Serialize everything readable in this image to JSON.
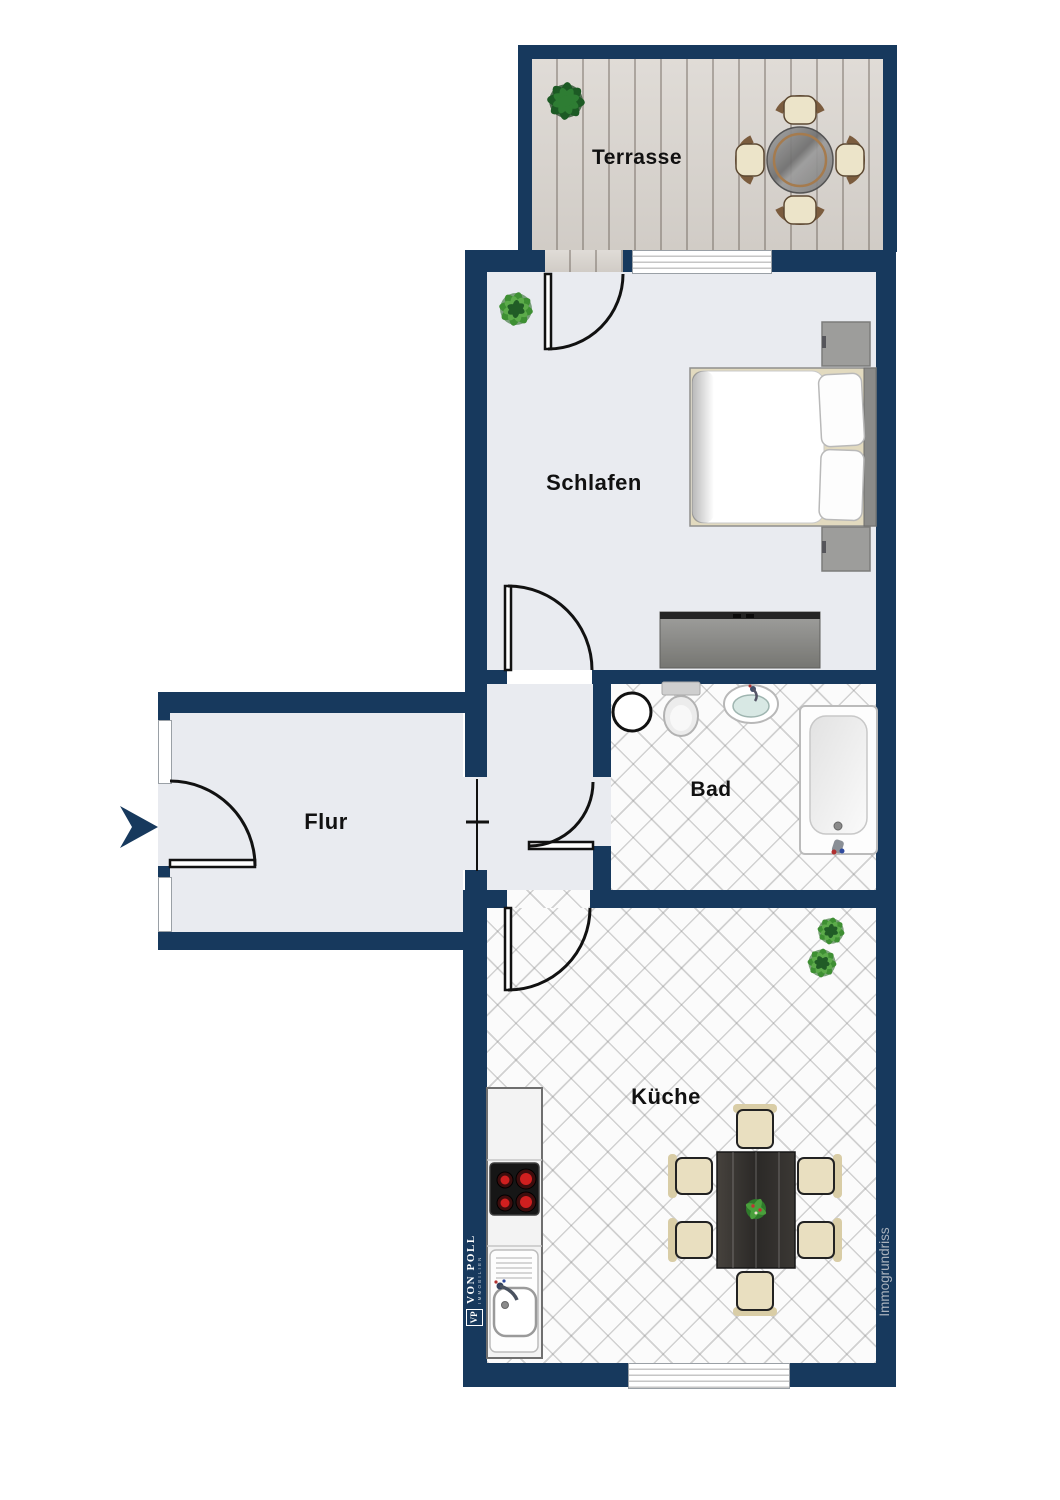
{
  "meta": {
    "type": "residential floor plan",
    "language": "de"
  },
  "rooms": [
    {
      "id": "terrasse",
      "label": "Terrasse"
    },
    {
      "id": "schlafen",
      "label": "Schlafen"
    },
    {
      "id": "bad",
      "label": "Bad"
    },
    {
      "id": "flur",
      "label": "Flur"
    },
    {
      "id": "kueche",
      "label": "Küche"
    }
  ],
  "branding": {
    "logo_initials": "VP",
    "logo_name": "VON POLL",
    "logo_sub": "IMMOBILIEN",
    "watermark": "Immogrundriss"
  },
  "colors": {
    "wall": "#17395d",
    "floor_gray": "#e9ebf0",
    "tile_white": "#fbfbfb",
    "deck_wood": "#d9d4ce",
    "burner_red": "#cf1f1f",
    "chair_cream": "#ece4c9",
    "watermark_gray": "#a9b2bd"
  }
}
